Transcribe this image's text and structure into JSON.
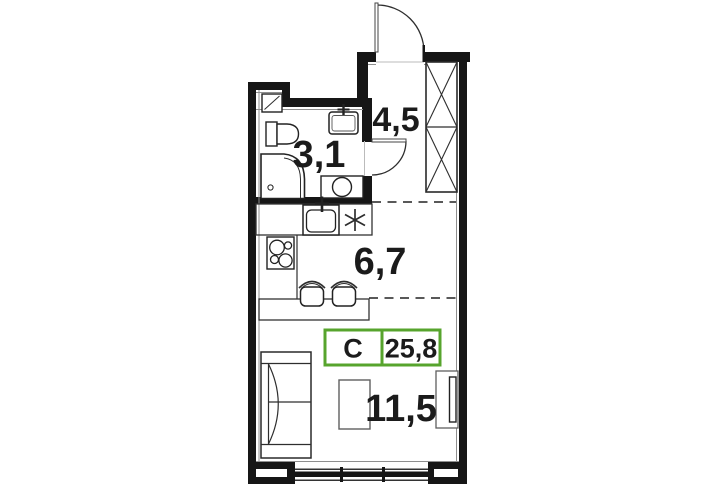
{
  "colors": {
    "accent_green": "#57a42d",
    "wall_black": "#161616"
  },
  "rooms": {
    "bathroom": {
      "area_label": "3,1"
    },
    "hall": {
      "area_label": "4,5"
    },
    "kitchen": {
      "area_label": "6,7"
    },
    "living": {
      "area_label": "11,5"
    }
  },
  "badge": {
    "apartment_type": "C",
    "total_area": "25,8"
  }
}
